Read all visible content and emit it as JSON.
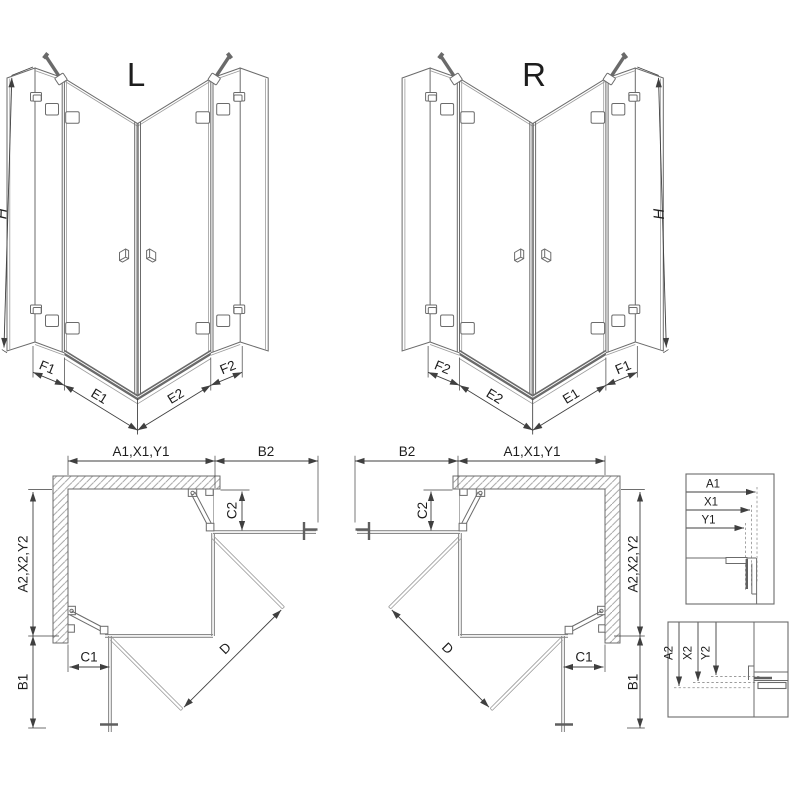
{
  "drawing": {
    "iso_left": {
      "variant_label": "L",
      "height_label": "H",
      "segment_labels": [
        "F1",
        "E1",
        "E2",
        "F2"
      ]
    },
    "iso_right": {
      "variant_label": "R",
      "height_label": "H",
      "segment_labels": [
        "F2",
        "E2",
        "E1",
        "F1"
      ]
    },
    "plan_left": {
      "width_label": "A1,X1,Y1",
      "side_panel_top_label": "B2",
      "depth_label": "A2,X2,Y2",
      "side_panel_bottom_label": "B1",
      "clearance_top_label": "C2",
      "clearance_bottom_label": "C1",
      "diagonal_label": "D"
    },
    "plan_right": {
      "width_label": "A1,X1,Y1",
      "side_panel_top_label": "B2",
      "depth_label": "A2,X2,Y2",
      "side_panel_bottom_label": "B1",
      "clearance_top_label": "C2",
      "clearance_bottom_label": "C1",
      "diagonal_label": "D"
    },
    "detail_width": {
      "labels": [
        "A1",
        "X1",
        "Y1"
      ]
    },
    "detail_depth": {
      "labels": [
        "A2",
        "X2",
        "Y2"
      ]
    },
    "colors": {
      "line": "#6b6b6b",
      "dark": "#3f3f3f",
      "light": "#9b9b9b",
      "text": "#1d1d1d",
      "glass": "#8b8b8b",
      "threshold": "#6a6a6a",
      "background": "#ffffff"
    }
  }
}
